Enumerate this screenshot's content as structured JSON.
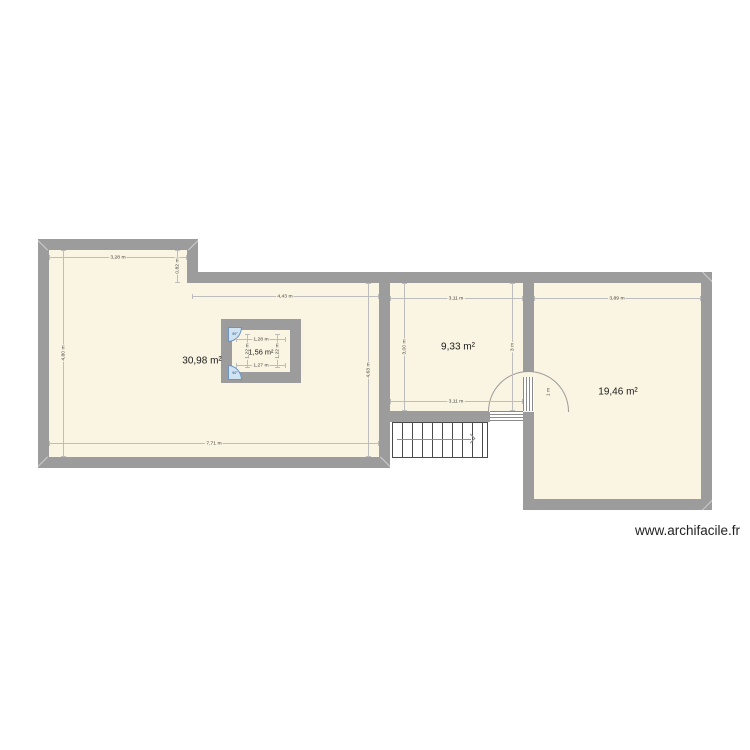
{
  "watermark": "www.archifacile.fr",
  "colors": {
    "room_fill": "#FAF5E2",
    "wall": "#9C9C9C",
    "dim_line": "#BDBDBD",
    "dim_text": "#3C3C3C",
    "stair_line": "#4A4A4A",
    "door_fan_fill": "#CFE3F3",
    "door_fan_stroke": "#6B93C4",
    "watermark_text": "#222222"
  },
  "rooms": {
    "left": {
      "area": "30,98 m²",
      "dims": {
        "top": "3,28 m",
        "notch": "0,82 m",
        "corridor": "4,43 m",
        "left": "4,80 m",
        "bottom": "7,71 m",
        "right": "4,63 m"
      }
    },
    "closet": {
      "area": "1,56 m²",
      "dims": {
        "top": "1,28 m",
        "bottom": "1,27 m",
        "left": "1,22 m",
        "right": "1,22 m"
      },
      "door_top_angle": "90°",
      "door_bottom_angle": "90°"
    },
    "middle": {
      "area": "9,33 m²",
      "dims": {
        "top": "3,11 m",
        "bottom": "3,11 m",
        "left": "3,00 m",
        "right": "3 m"
      }
    },
    "right": {
      "area": "19,46 m²",
      "dims": {
        "top": "3,89 m"
      },
      "door_width": "1 m"
    }
  }
}
